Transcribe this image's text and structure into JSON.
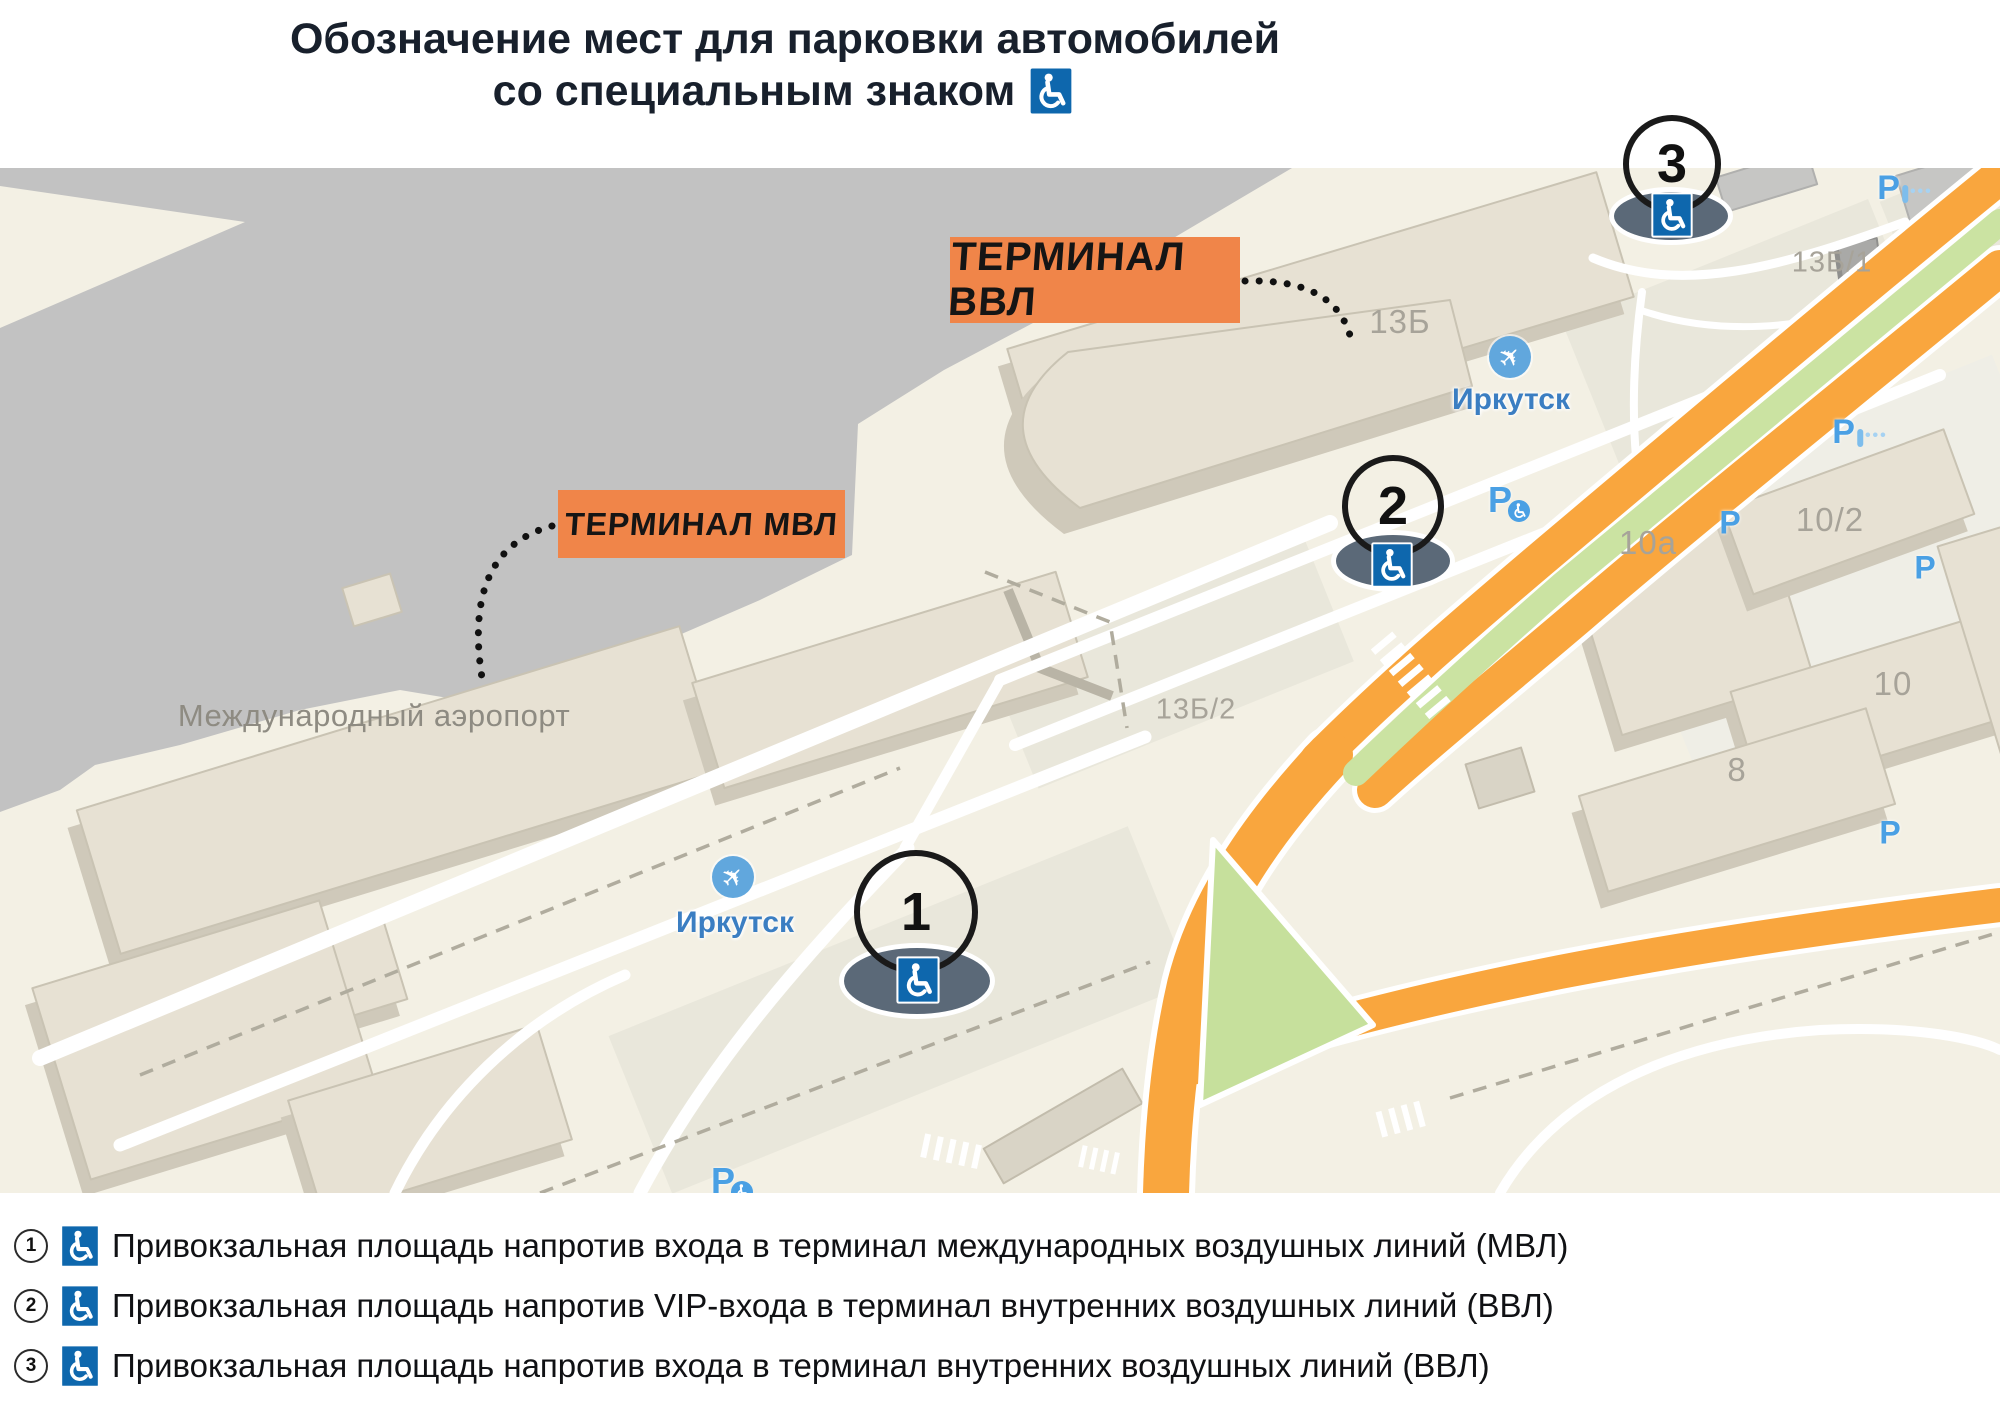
{
  "title": {
    "line1": "Обозначение мест для парковки автомобилей",
    "line2": "со специальным знаком"
  },
  "tags": {
    "vvl": "ТЕРМИНАЛ ВВЛ",
    "mvl": "ТЕРМИНАЛ МВЛ"
  },
  "map": {
    "labels": {
      "airport": "Международный аэропорт",
      "city_a": "Иркутск",
      "city_b": "Иркутск",
      "b13": "13Б",
      "b13_1": "13Б/1",
      "b13_2": "13Б/2",
      "b10a": "10а",
      "b10_2": "10/2",
      "b10": "10",
      "b8": "8"
    },
    "p_label": "P"
  },
  "markers": [
    {
      "n": "1"
    },
    {
      "n": "2"
    },
    {
      "n": "3"
    }
  ],
  "legend": {
    "items": [
      {
        "n": "1",
        "text": "Привокзальная площадь напротив входа в терминал международных воздушных линий (МВЛ)"
      },
      {
        "n": "2",
        "text": "Привокзальная площадь напротив VIP-входа в терминал внутренних воздушных линий (ВВЛ)"
      },
      {
        "n": "3",
        "text": "Привокзальная площадь напротив входа в терминал внутренних воздушных линий (ВВЛ)"
      }
    ]
  },
  "colors": {
    "accent_orange": "#f08549",
    "sign_blue": "#0e67ad",
    "marker_slate": "#5b6978",
    "parking_blue": "#4aa0e4",
    "road_orange": "#f9a63e",
    "green": "#cbe3a2",
    "map_cream": "#f3f0e4",
    "apron_gray": "#c2c2c2"
  }
}
